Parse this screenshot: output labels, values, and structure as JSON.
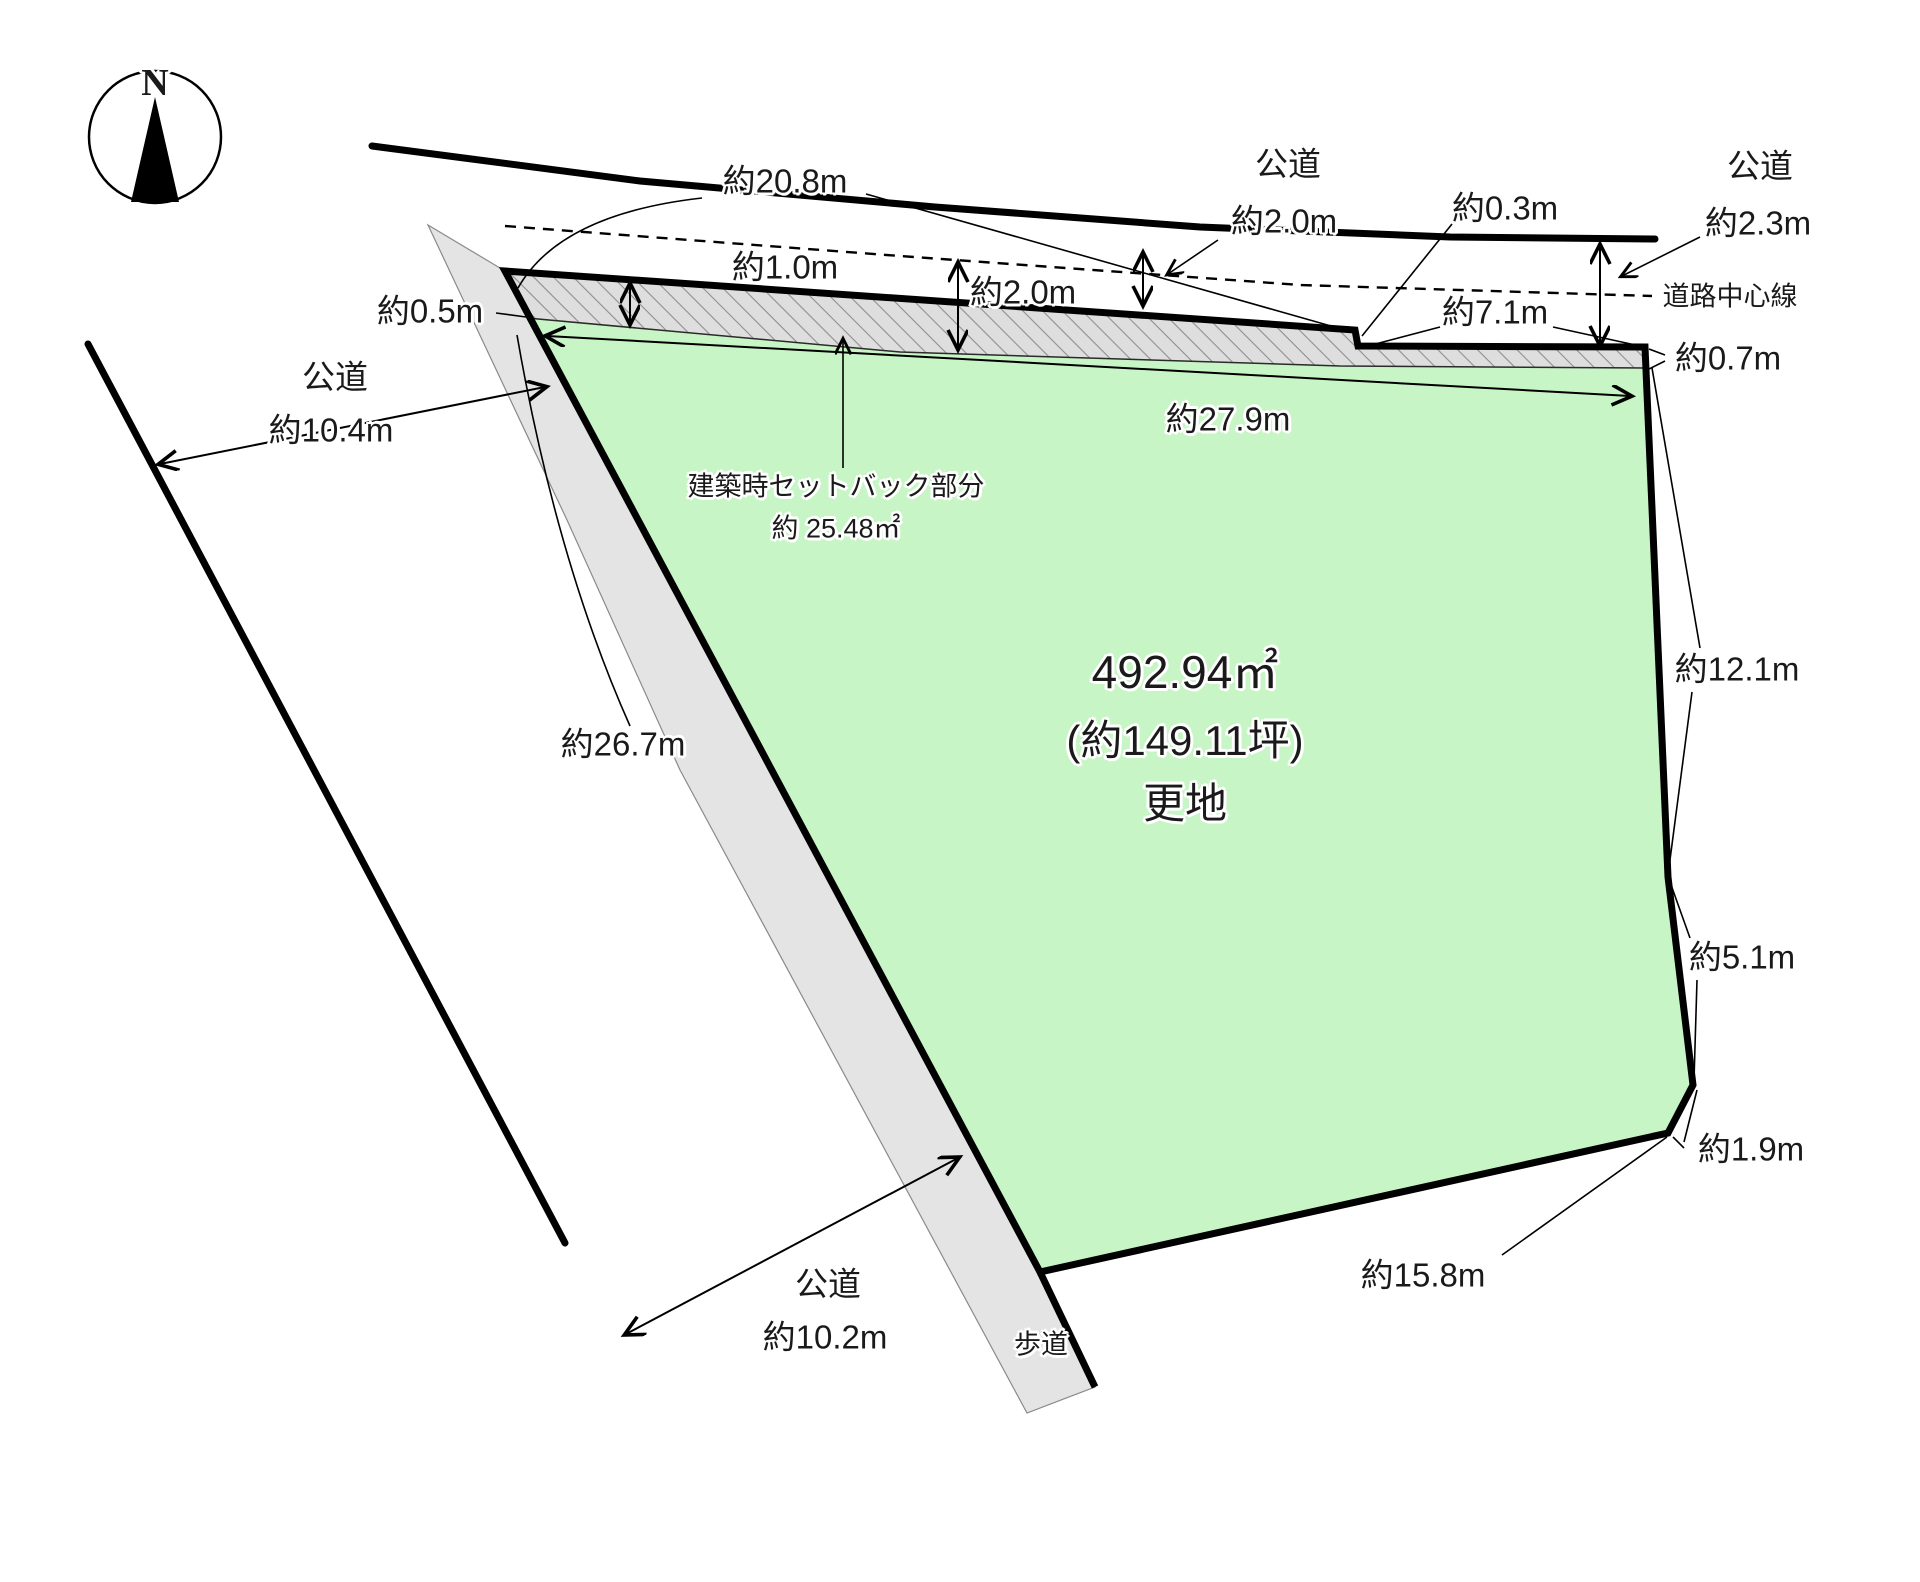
{
  "canvas": {
    "width": 1920,
    "height": 1582,
    "background": "#ffffff"
  },
  "colors": {
    "land_fill": "#c8f5c6",
    "road_fill": "#e4e4e4",
    "hatch_bg": "#dedede",
    "hatch_line": "#8f8f8f",
    "outline": "#000000"
  },
  "compass": {
    "letter": "N"
  },
  "parcel": {
    "area_m2": "492.94㎡",
    "area_tsubo": "(約149.11坪)",
    "status": "更地"
  },
  "setback": {
    "caption": "建築時セットバック部分",
    "area": "約 25.48㎡"
  },
  "labels": {
    "road_top_center": "公道",
    "road_top_center_width": "約2.0m",
    "road_top_right": "公道",
    "road_top_right_width": "約2.3m",
    "road_left": "公道",
    "road_left_width": "約10.4m",
    "road_bottom": "公道",
    "road_bottom_width": "約10.2m",
    "road_center_line": "道路中心線",
    "sidewalk": "歩道",
    "frontage_total": "約20.8m",
    "setback_left_depth": "約1.0m",
    "setback_mid_depth": "約2.0m",
    "boundary_step": "約0.3m",
    "frontage_right": "約7.1m",
    "corner_left": "約0.5m",
    "strip_right": "約0.7m",
    "inner_frontage": "約27.9m",
    "west_edge": "約26.7m",
    "east_edge_upper": "約12.1m",
    "east_edge_lower": "約5.1m",
    "corner_bevel": "約1.9m",
    "south_edge": "約15.8m"
  }
}
